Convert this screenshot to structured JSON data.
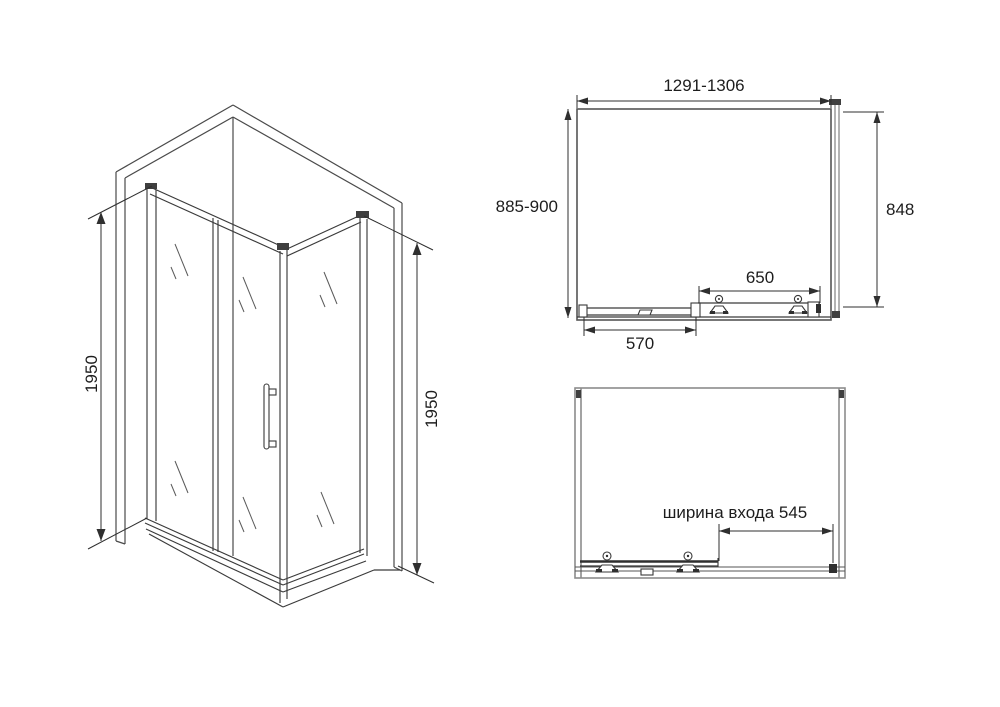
{
  "colors": {
    "background": "#ffffff",
    "line_dark": "#3a3a3a",
    "line_gray": "#9a9a9a",
    "frame_gray": "#8c8c8c",
    "text": "#1d1d1d"
  },
  "isometric_view": {
    "height_left": "1950",
    "height_right": "1950"
  },
  "top_view": {
    "width_range": "1291-1306",
    "depth_range": "885-900",
    "side_panel_width": "848",
    "door_rail_span": "650",
    "fixed_panel_span": "570"
  },
  "front_view": {
    "entrance_width": "ширина входа 545"
  }
}
